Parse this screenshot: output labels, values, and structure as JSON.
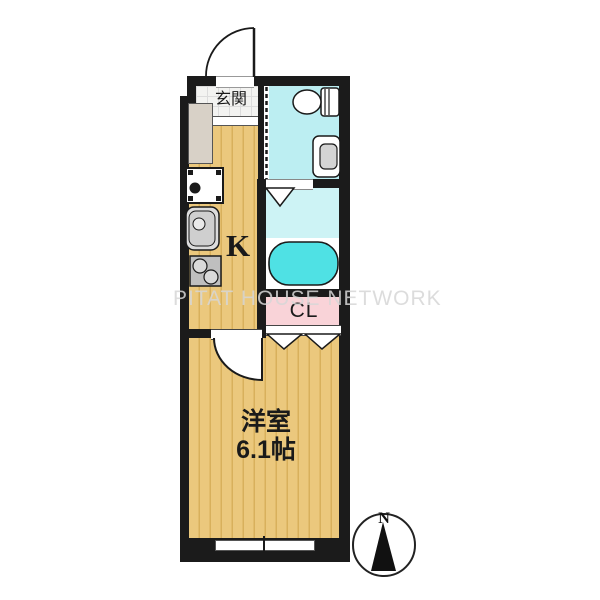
{
  "document_type": "apartment-floor-plan",
  "watermark": "PITAT HOUSE NETWORK",
  "labels": {
    "entrance": "玄関",
    "kitchen": "K",
    "closet": "CL",
    "bedroom_name": "洋室",
    "bedroom_size": "6.1帖",
    "compass_north": "N"
  },
  "fixtures": [
    "entrance-door",
    "toilet",
    "washbasin",
    "bathtub",
    "washing-machine-pan",
    "kitchen-sink",
    "gas-stove",
    "folding-door-bath",
    "folding-door-closet",
    "bedroom-door",
    "sliding-window",
    "compass",
    "shoe-cabinet"
  ],
  "colors": {
    "wall": "#1b1b1b",
    "flooring": "#ebc87d",
    "flooring_stripe": "#d8b05c",
    "toilet_floor": "#bceef2",
    "bath_floor": "#cdf3f5",
    "bathtub": "#4fe1e4",
    "closet_fill": "#f9d3d8",
    "genkan_tile": "#f3f3f1",
    "cabinet": "#d8d1c7",
    "watermark_gray": "#d7d7d7"
  }
}
